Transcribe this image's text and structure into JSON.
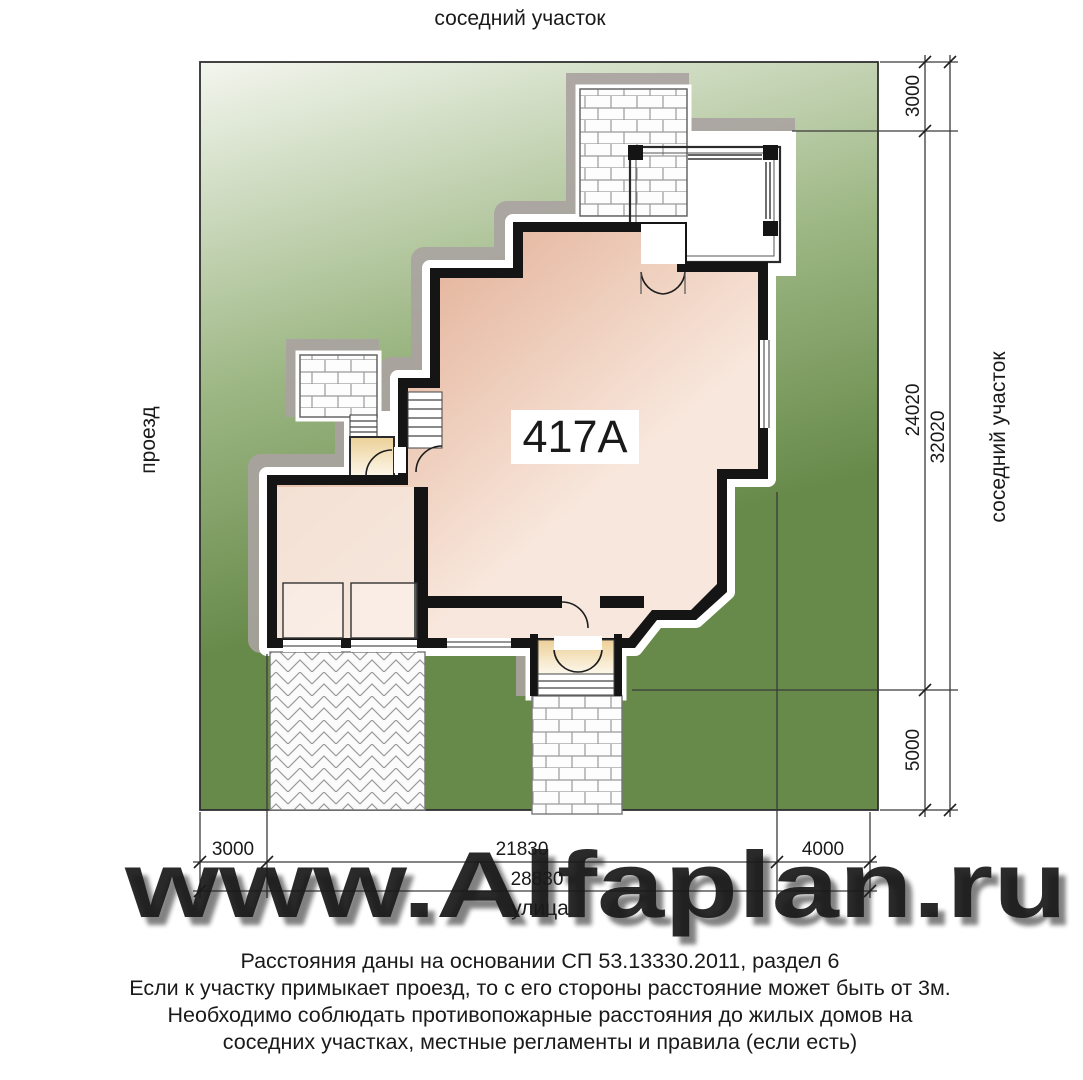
{
  "site": {
    "top_label": "соседний участок",
    "right_label": "соседний участок",
    "left_label": "проезд",
    "bottom_label": "улица"
  },
  "house": {
    "label": "417A"
  },
  "dimensions": {
    "right": {
      "top": "3000",
      "middle": "24020",
      "bottom": "5000",
      "total": "32020"
    },
    "bottom": {
      "left": "3000",
      "middle": "21830",
      "right": "4000",
      "total": "28830"
    }
  },
  "watermark": "www.Alfaplan.ru",
  "notes": {
    "line1": "Расстояния даны на основании СП 53.13330.2011, раздел 6",
    "line2": "Если к участку примыкает проезд, то с его стороны расстояние может быть от 3м.",
    "line3": "Необходимо соблюдать противопожарные расстояния до жилых домов на",
    "line4": "соседних участках, местные регламенты и правила (если есть)"
  },
  "colors": {
    "lawn_light": "#f3f6ee",
    "lawn_mid": "#9db784",
    "lawn_dark": "#678a4a",
    "house_dark": "#dc9f81",
    "house_light": "#f8e7dc",
    "terrace_dark": "#ecd098",
    "terrace_light": "#fdf8ec",
    "wall": "#151515",
    "shadow": "#aaa3a1",
    "blind": "#dbd7d5",
    "brick_line": "#999999"
  }
}
